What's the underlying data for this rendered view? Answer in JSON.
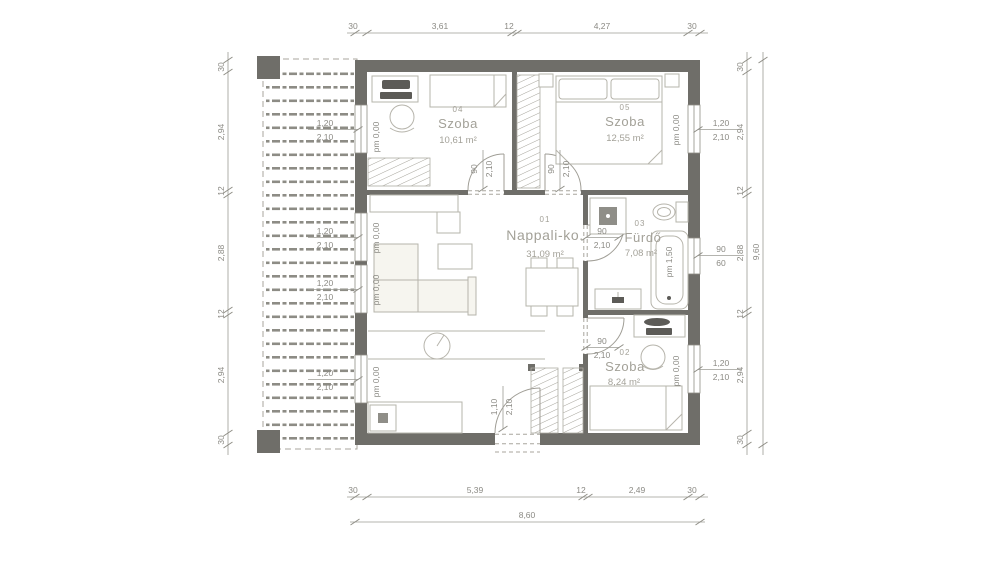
{
  "drawing": {
    "type": "floor-plan",
    "rooms": [
      {
        "num": "04",
        "name": "Szoba",
        "area": "10,61 m²"
      },
      {
        "num": "05",
        "name": "Szoba",
        "area": "12,55 m²"
      },
      {
        "num": "01",
        "name": "Nappali-ko.",
        "area": "31,09 m²"
      },
      {
        "num": "03",
        "name": "Fürdő",
        "area": "7,08 m²"
      },
      {
        "num": "02",
        "name": "Szoba",
        "area": "8,24 m²"
      }
    ],
    "openings": {
      "window_large": {
        "w": "1,20",
        "h": "2,10",
        "sill": "pm 0,00"
      },
      "window_small": {
        "w": "90",
        "h": "60",
        "sill": "pm 1,50"
      },
      "door_interior": {
        "w": "90",
        "h": "2,10"
      },
      "door_entry": {
        "w": "1,10",
        "h": "2,10"
      }
    },
    "dims": {
      "top": [
        "30",
        "3,61",
        "12",
        "4,27",
        "30"
      ],
      "bottom": [
        "30",
        "5,39",
        "12",
        "2,49",
        "30"
      ],
      "left": [
        "30",
        "2,94",
        "12",
        "2,88",
        "12",
        "2,94",
        "30"
      ],
      "right": [
        "30",
        "2,94",
        "12",
        "2,88",
        "12",
        "2,94",
        "30"
      ],
      "total_width": "8,60",
      "total_height": "9,60"
    },
    "colors": {
      "wall": "#6f6e69",
      "furniture_line": "#b6b4ab",
      "label_text": "#a3a198",
      "dimension_text": "#8b8a84",
      "background": "#ffffff"
    }
  }
}
